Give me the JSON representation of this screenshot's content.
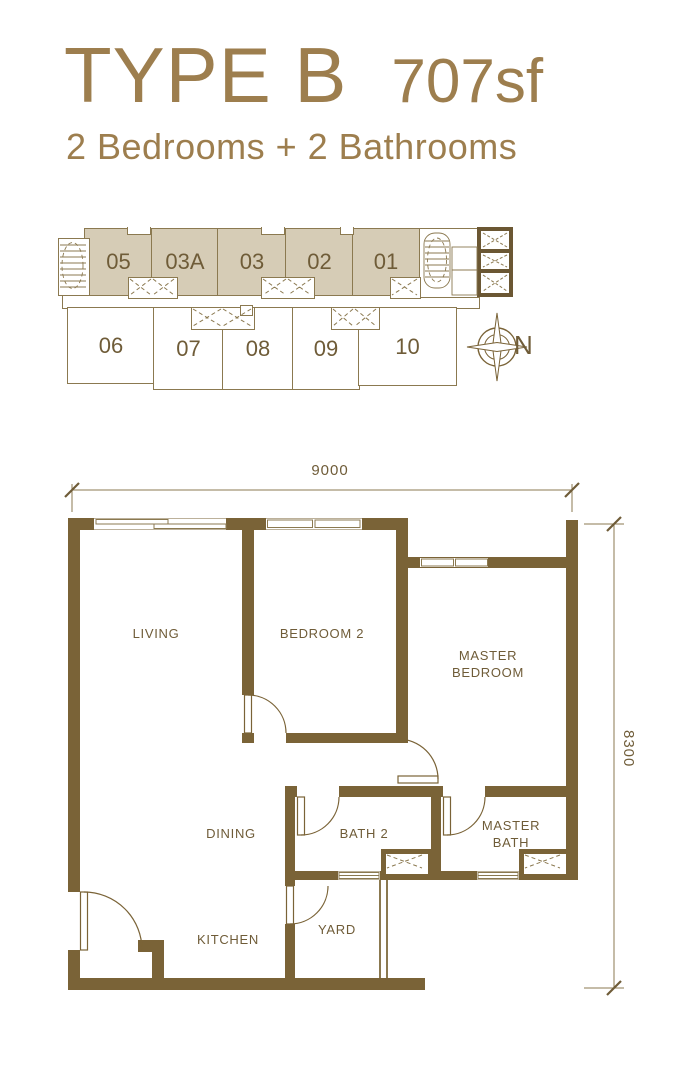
{
  "header": {
    "title": "TYPE B",
    "area": "707sf",
    "subtitle": "2 Bedrooms + 2 Bathrooms"
  },
  "key_plan": {
    "upper_units": [
      "05",
      "03A",
      "03",
      "02",
      "01"
    ],
    "lower_units": [
      "06",
      "07",
      "08",
      "09",
      "10"
    ],
    "compass_label": "N",
    "highlight_fill": "#d6ccb6",
    "icons": {
      "left_stair": "stairwell",
      "right_stair": "stairwell",
      "lift_core": "elevator-shaft",
      "compass": "compass-rose"
    }
  },
  "floor_plan": {
    "rooms": {
      "living": "LIVING",
      "bedroom2": "BEDROOM 2",
      "master_bedroom": "MASTER BEDROOM",
      "dining": "DINING",
      "bath2": "BATH 2",
      "master_bath": "MASTER BATH",
      "kitchen": "KITCHEN",
      "yard": "YARD"
    },
    "dimensions": {
      "width": "9000",
      "depth": "8300"
    }
  },
  "colors": {
    "accent": "#9d7e4e",
    "wall": "#7a6337",
    "thin_line": "#8b7950",
    "label": "#6f5c38",
    "unit_fill": "#d6ccb6",
    "lift_wall": "#6b5733"
  }
}
